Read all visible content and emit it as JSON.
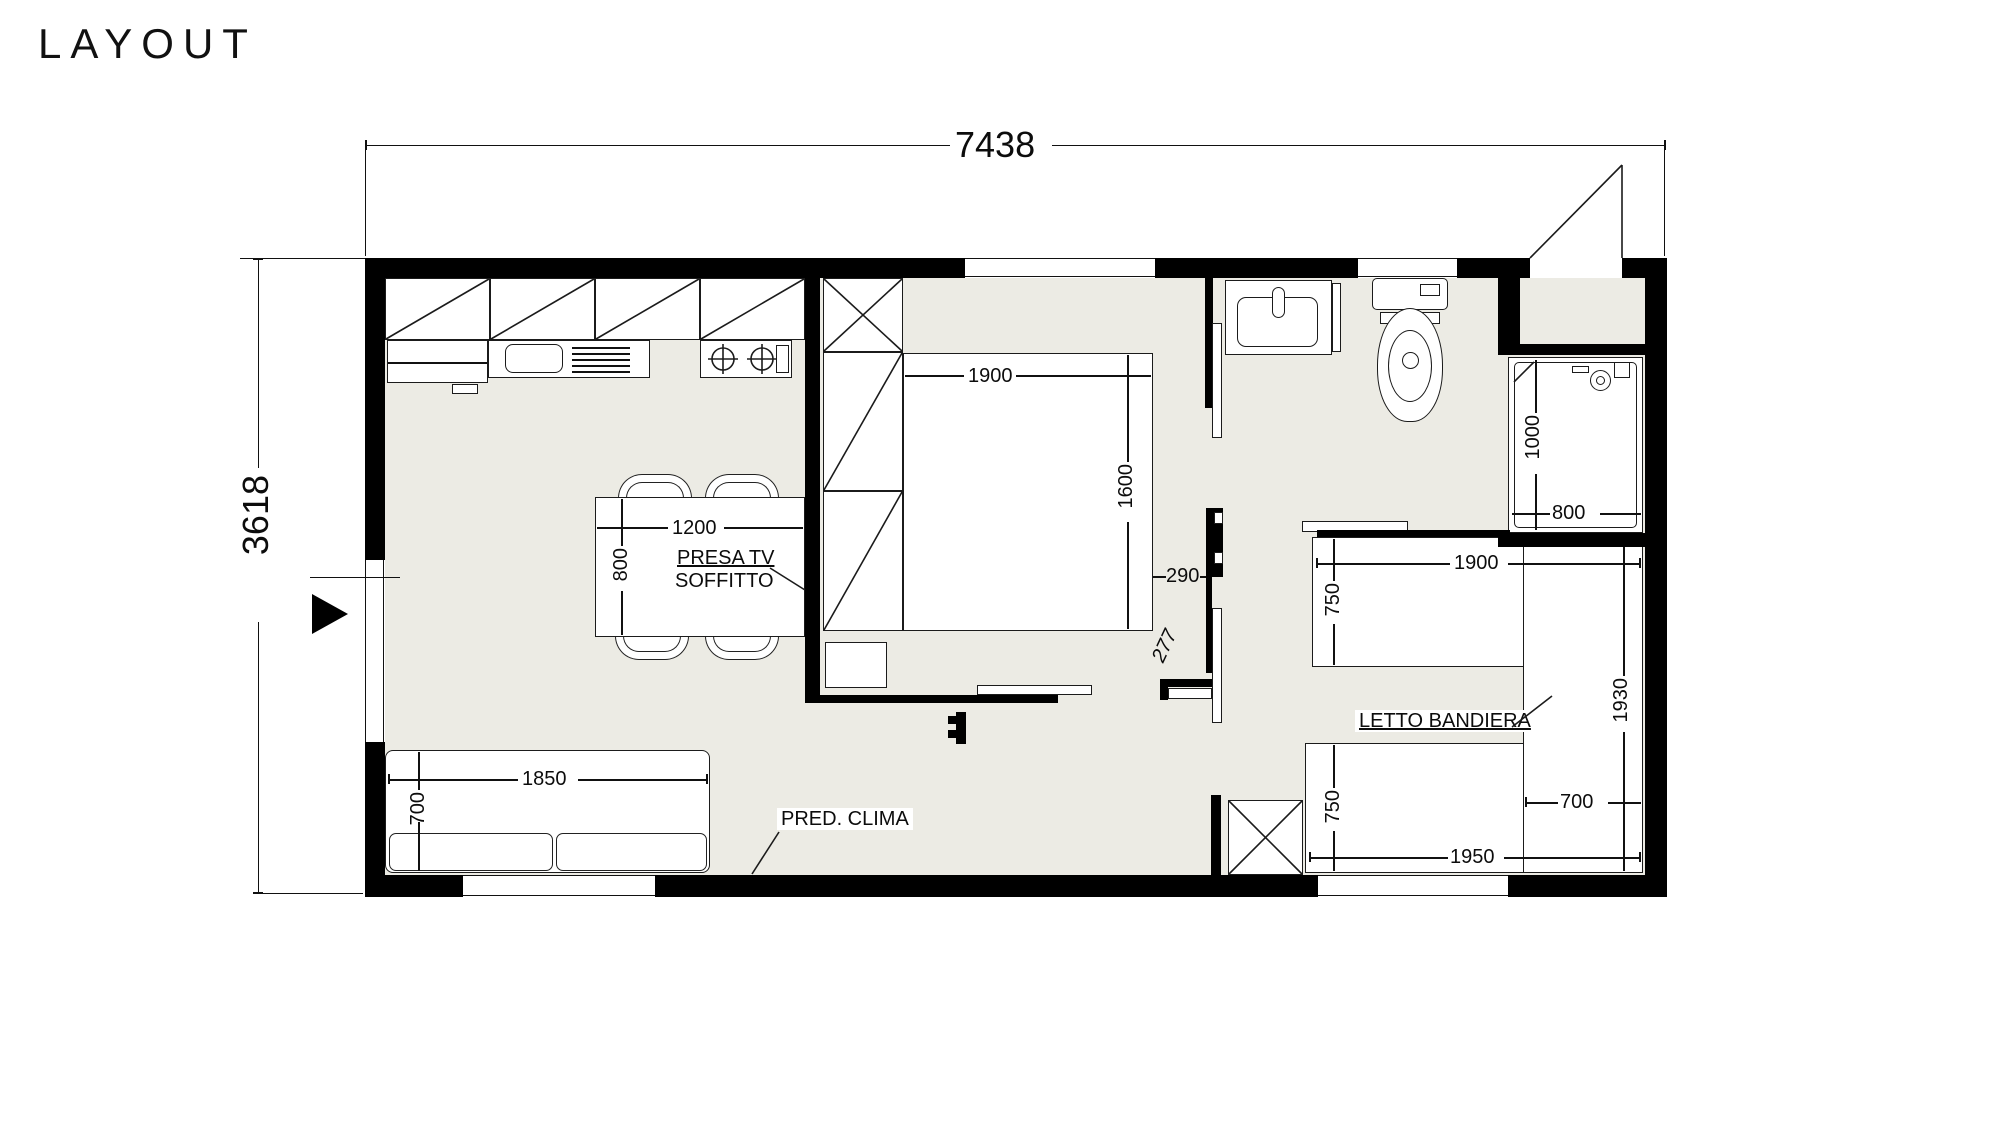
{
  "title": "LAYOUT",
  "dims": {
    "overall_w": "7438",
    "overall_h": "3618",
    "bed1_w": "1900",
    "bed1_d": "1600",
    "table_w": "1200",
    "table_d": "800",
    "wall_gap": "290",
    "opening": "277",
    "sofa_w": "1850",
    "sofa_d": "700",
    "shower_l": "1000",
    "shower_w": "800",
    "bed2a_w": "1900",
    "bed2a_d": "750",
    "bed2b_w": "1950",
    "bed2b_d": "750",
    "flag_l": "1930",
    "flag_w": "700"
  },
  "labels": {
    "presa_tv_1": "PRESA TV",
    "presa_tv_2": "SOFFITTO",
    "letto_bandiera": "LETTO BANDIERA",
    "pred_clima": "PRED. CLIMA"
  },
  "colors": {
    "floor": "#ECEBE4",
    "wall": "#000000"
  }
}
